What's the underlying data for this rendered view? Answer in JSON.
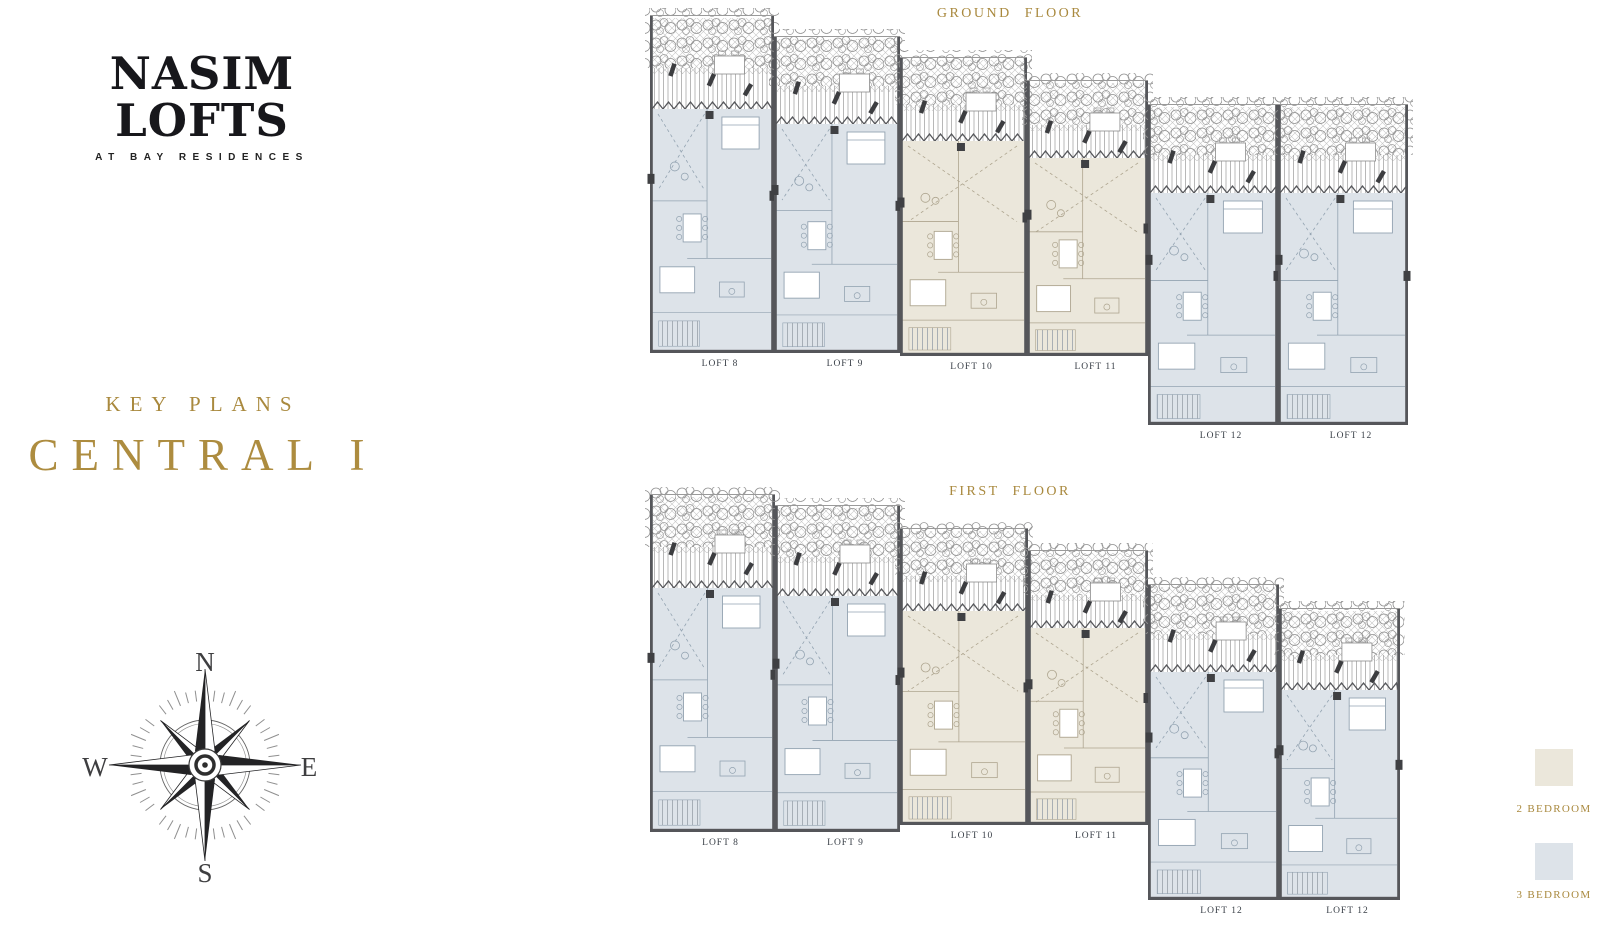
{
  "brand": {
    "name": "NASIM LOFTS",
    "tagline": "AT BAY RESIDENCES"
  },
  "key_plans": {
    "eyebrow": "KEY PLANS",
    "title": "CENTRAL I"
  },
  "compass": {
    "north": "N",
    "east": "E",
    "south": "S",
    "west": "W"
  },
  "floors": [
    {
      "id": "ground",
      "title": "GROUND FLOOR",
      "lofts": [
        {
          "label": "LOFT 8",
          "type": "3 BEDROOM"
        },
        {
          "label": "LOFT 9",
          "type": "3 BEDROOM"
        },
        {
          "label": "LOFT 10",
          "type": "2 BEDROOM"
        },
        {
          "label": "LOFT 11",
          "type": "2 BEDROOM"
        },
        {
          "label": "LOFT 12",
          "type": "3 BEDROOM"
        },
        {
          "label": "LOFT 12",
          "type": "3 BEDROOM"
        }
      ]
    },
    {
      "id": "first",
      "title": "FIRST FLOOR",
      "lofts": [
        {
          "label": "LOFT 8",
          "type": "3 BEDROOM"
        },
        {
          "label": "LOFT 9",
          "type": "3 BEDROOM"
        },
        {
          "label": "LOFT 10",
          "type": "2 BEDROOM"
        },
        {
          "label": "LOFT 11",
          "type": "2 BEDROOM"
        },
        {
          "label": "LOFT 12",
          "type": "3 BEDROOM"
        },
        {
          "label": "LOFT 12",
          "type": "3 BEDROOM"
        }
      ]
    }
  ],
  "legend": {
    "items": [
      {
        "label": "2 BEDROOM",
        "color": "#EBE7DB",
        "line": "#AEA58F"
      },
      {
        "label": "3 BEDROOM",
        "color": "#DDE3E9",
        "line": "#93A3B1"
      }
    ]
  },
  "palette": {
    "gold": "#A9893E",
    "ink": "#17171B",
    "label": "#3A4048",
    "wall": "#55565A"
  }
}
